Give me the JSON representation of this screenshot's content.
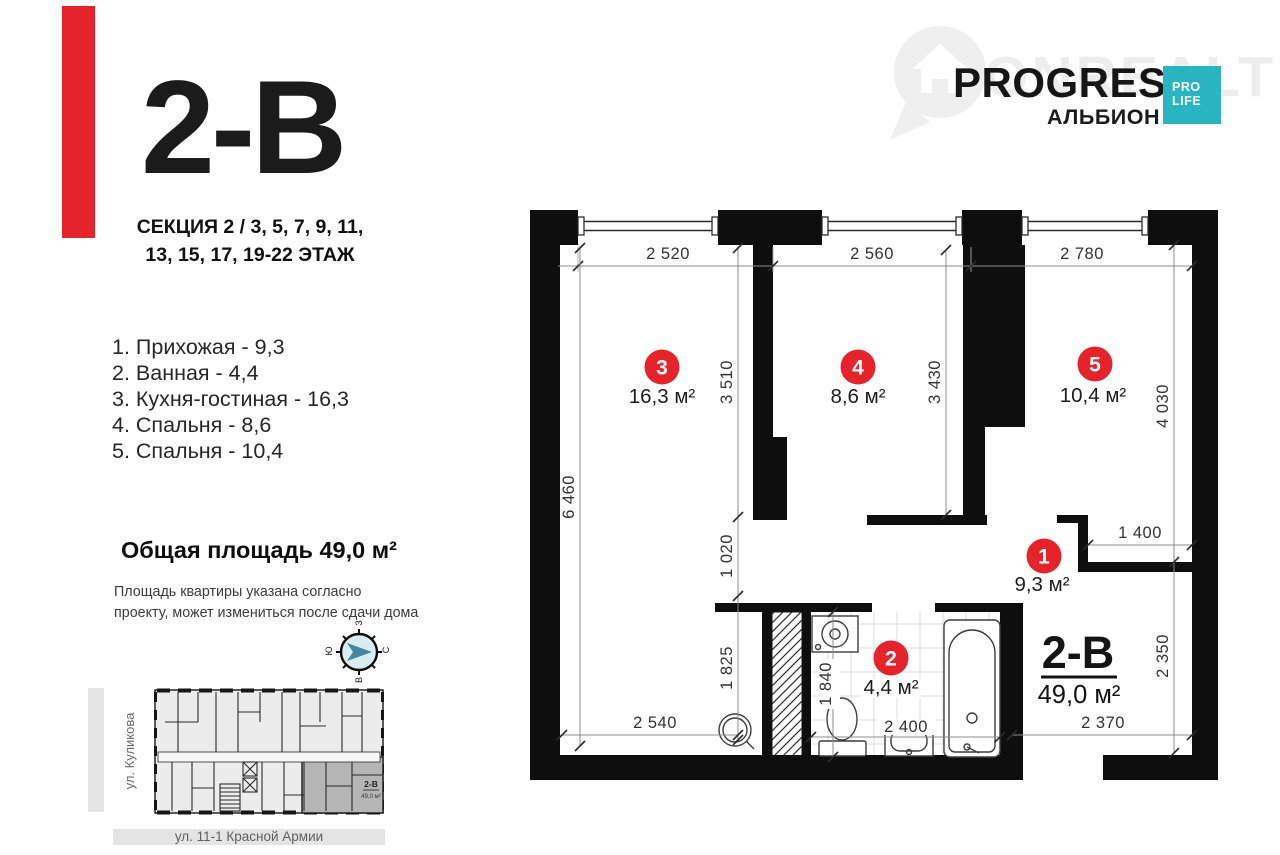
{
  "header": {
    "unit_code": "2-B",
    "section_line1": "СЕКЦИЯ 2 / 3, 5, 7, 9, 11,",
    "section_line2": "13, 15, 17, 19-22 ЭТАЖ"
  },
  "room_list": [
    "1. Прихожая - 9,3",
    "2. Ванная - 4,4",
    "3. Кухня-гостиная - 16,3",
    "4. Спальня - 8,6",
    "5. Спальня - 10,4"
  ],
  "total_area_text": "Общая площадь 49,0 м²",
  "disclaimer_line1": "Площадь квартиры указана согласно",
  "disclaimer_line2": "проекту, может измениться после сдачи дома",
  "logo": {
    "watermark": "ONREALT",
    "brand": "PROGRESS",
    "sub": "АЛЬБИОН",
    "badge_line1": "PRO",
    "badge_line2": "LIFE"
  },
  "compass": {
    "top": "З",
    "right": "С",
    "bottom": "В",
    "left": "Ю"
  },
  "plan": {
    "unit_label": "2-В",
    "unit_area": "49,0 м²",
    "dims": {
      "top1": "2 520",
      "top2": "2 560",
      "top3": "2 780",
      "left": "6 460",
      "inner1": "3 510",
      "inner2": "1 020",
      "inner3": "1 825",
      "room4": "3 430",
      "room5": "4 030",
      "niche": "1 400",
      "right_lower": "2 350",
      "bottom_left": "2 540",
      "bath_width": "2 400",
      "bath_height": "1 840",
      "bottom_right": "2 370"
    },
    "rooms": [
      {
        "num": "3",
        "area": "16,3 м²"
      },
      {
        "num": "4",
        "area": "8,6 м²"
      },
      {
        "num": "5",
        "area": "10,4 м²"
      },
      {
        "num": "1",
        "area": "9,3 м²"
      },
      {
        "num": "2",
        "area": "4,4 м²"
      }
    ]
  },
  "mini_plan": {
    "street_left": "ул. Куликова",
    "street_bottom": "ул. 11-1 Красной Армии",
    "unit_label": "2-В",
    "unit_area": "49,0 м²"
  },
  "colors": {
    "accent_red": "#e5232b",
    "brand_teal": "#2ab5c2"
  }
}
